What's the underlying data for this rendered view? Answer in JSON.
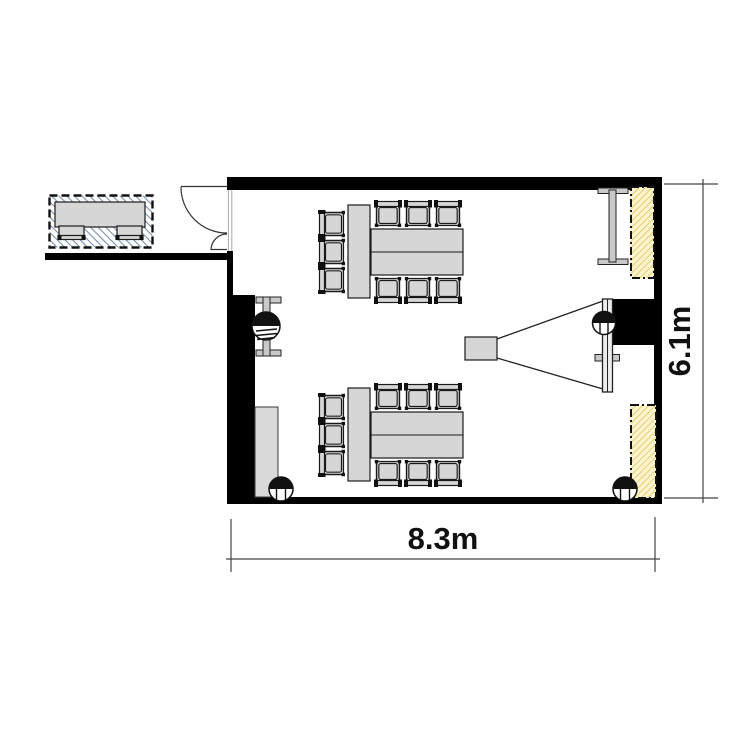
{
  "meta": {
    "type": "floor-plan",
    "room": "meeting-room"
  },
  "labels": {
    "width": "8.3m",
    "height": "6.1m"
  },
  "dimensions": {
    "room_width_m": 8.3,
    "room_height_m": 6.1
  },
  "colors": {
    "wall": "#000000",
    "furniture_fill": "#d6d6d6",
    "furniture_stroke": "#1a1a1a",
    "panel_fill": "#fbf4cf",
    "panel_hatch": "#e0bc45",
    "external_hatch": "#6e89a8",
    "dimension_line": "#444444"
  },
  "furniture": {
    "seating_groups": [
      {
        "name": "upper-conference-table",
        "seats": 9
      },
      {
        "name": "lower-conference-table",
        "seats": 9
      }
    ],
    "equipment": [
      "projector",
      "projection-screen",
      "wall-board",
      "radiator",
      "cabinet",
      "window-panel-top",
      "window-panel-bottom",
      "column-mid-left",
      "column-mid-right",
      "column-bottom-left",
      "column-bottom-right"
    ],
    "door": "double-leaf-entrance-door",
    "external": {
      "name": "hall-table",
      "seats": 2
    }
  }
}
